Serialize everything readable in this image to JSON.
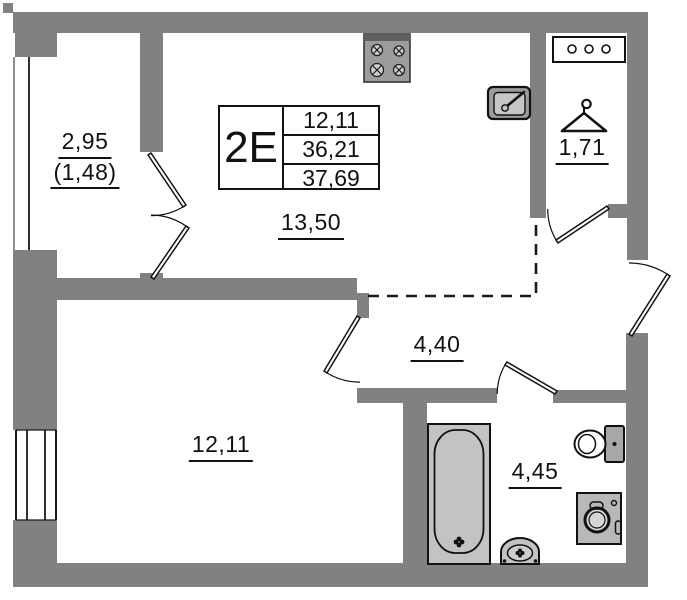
{
  "title_block": {
    "unit_type": "2E",
    "rows": [
      "12,11",
      "36,21",
      "37,69"
    ]
  },
  "rooms": {
    "balcony": {
      "area": "2,95",
      "area_reduced": "(1,48)"
    },
    "kitchen_living": {
      "area": "13,50"
    },
    "hallway": {
      "area": "1,71"
    },
    "corridor": {
      "area": "4,40"
    },
    "bedroom": {
      "area": "12,11"
    },
    "bathroom": {
      "area": "4,45"
    }
  },
  "icons": [
    "stove-icon",
    "kitchen-sink-icon",
    "cabinet-icon",
    "hanger-icon",
    "bathtub-icon",
    "washbasin-icon",
    "toilet-icon",
    "washing-machine-icon"
  ],
  "colors": {
    "wall": "#818181",
    "fixture_fill": "#c3c3c3",
    "line": "#111111"
  }
}
